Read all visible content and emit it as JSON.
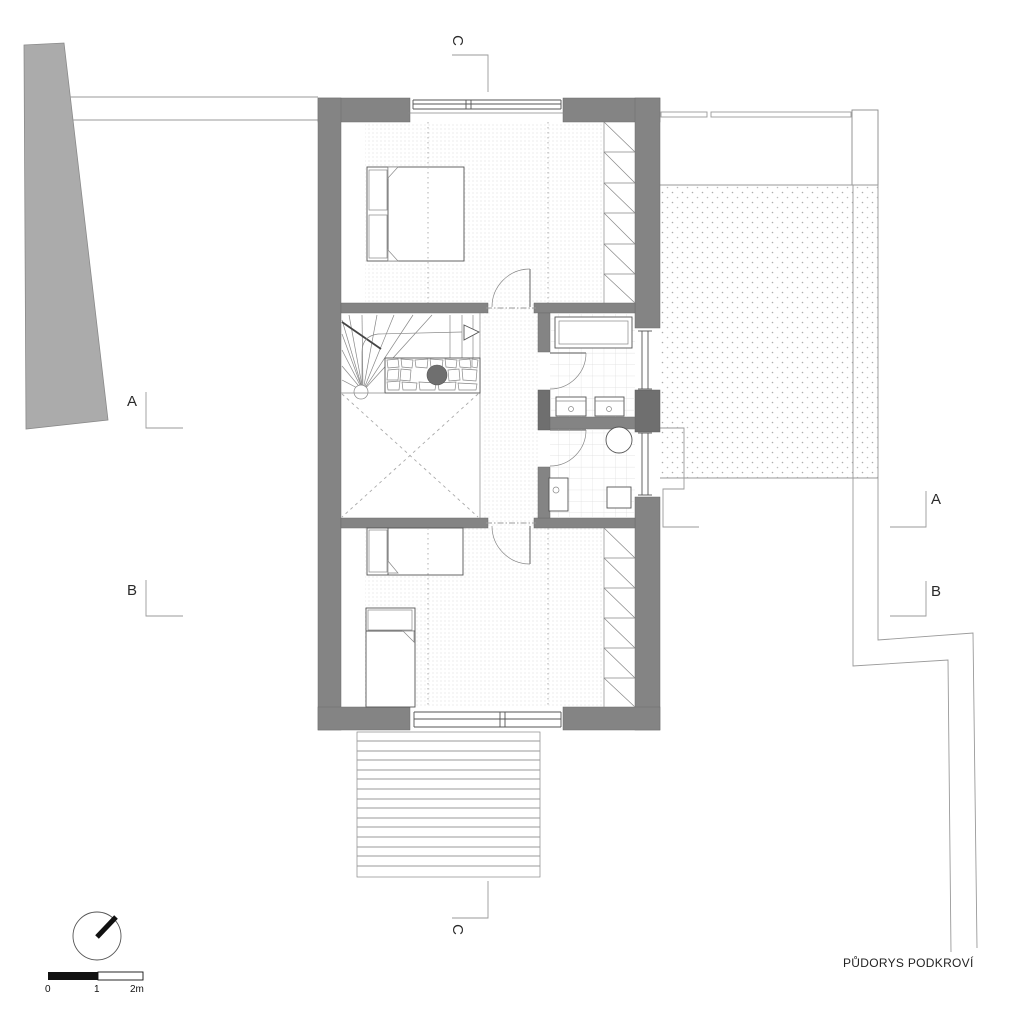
{
  "title": "PŮDORYS PODKROVÍ",
  "section_markers": {
    "left_a": "A",
    "left_b": "B",
    "right_a": "A",
    "right_b": "B",
    "top_c": "C",
    "bottom_c": "C"
  },
  "scale_bar": {
    "label_0": "0",
    "label_1": "1",
    "label_2": "2m"
  },
  "icons": {
    "north_arrow": "compass-circle-with-needle"
  },
  "colors": {
    "wall": "#848484",
    "wall_dark": "#6f6f6f",
    "site_gray": "#ababab",
    "line": "#555555",
    "flue": "#6f6f6f",
    "scale_black": "#111111"
  }
}
